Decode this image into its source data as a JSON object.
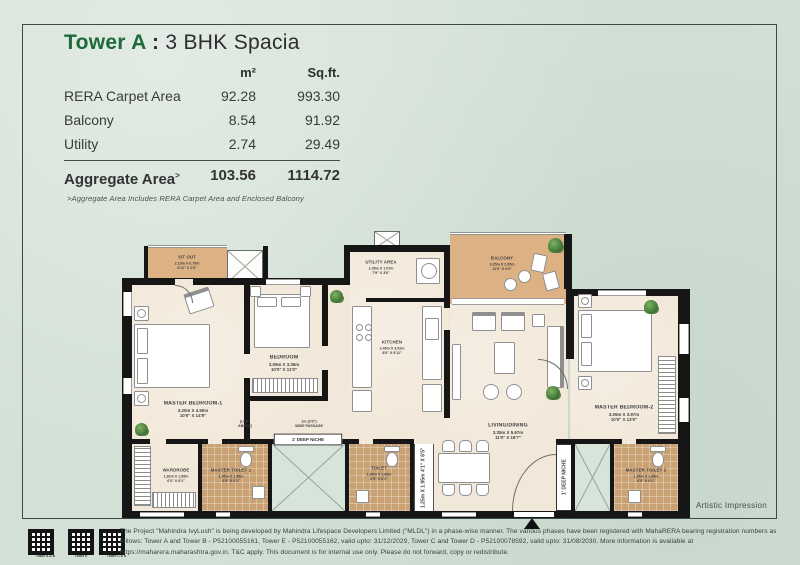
{
  "title": {
    "tower": "Tower A",
    "colon": " : ",
    "plan": "3 BHK Spacia"
  },
  "area_table": {
    "headers": {
      "m2": "m²",
      "sqft": "Sq.ft."
    },
    "rows": [
      {
        "label": "RERA Carpet Area",
        "m2": "92.28",
        "sqft": "993.30"
      },
      {
        "label": "Balcony",
        "m2": "8.54",
        "sqft": "91.92"
      },
      {
        "label": "Utility",
        "m2": "2.74",
        "sqft": "29.49"
      }
    ],
    "aggregate": {
      "label": "Aggregate Area",
      "marker": "˃",
      "m2": "103.56",
      "sqft": "1114.72"
    },
    "footnote": "˃Aggregate Area Includes RERA Carpet Area and Enclosed Balcony"
  },
  "rooms": {
    "sit_out": {
      "name": "SIT OUT",
      "dim_m": "2.10m X 0.75m",
      "dim_ft": "6'11\" X 2'6\""
    },
    "master_bedroom_1": {
      "name": "MASTER BEDROOM-1",
      "dim_m": "3.20m X 4.50m",
      "dim_ft": "10'6\" X 14'9\""
    },
    "bedroom": {
      "name": "BEDROOM",
      "dim_m": "3.05m X 3.35m",
      "dim_ft": "10'0\" X 11'0\""
    },
    "utility": {
      "name": "UTILITY AREA",
      "dim_m": "2.35m X 1.07m",
      "dim_ft": "7'9\" X 3'6\""
    },
    "kitchen": {
      "name": "KITCHEN",
      "dim_m": "2.45m X 3.02m",
      "dim_ft": "8'0\" X 9'11\""
    },
    "balcony": {
      "name": "BALCONY",
      "dim_m": "3.35m X 2.05m",
      "dim_ft": "11'0\" X 6'9\""
    },
    "living": {
      "name": "LIVING/DINING",
      "dim_m": "3.35m X 5.67m",
      "dim_ft": "11'0\" X 18'7\""
    },
    "master_bedroom_2": {
      "name": "MASTER BEDROOM-2",
      "dim_m": "3.05m X 3.97m",
      "dim_ft": "10'0\" X 13'0\""
    },
    "wardrobe": {
      "name": "WARDROBE",
      "dim_m": "1.82m X 1.85m",
      "dim_ft": "6'0\" X 6'1\""
    },
    "master_toilet_1": {
      "name": "MASTER TOILET 1",
      "dim_m": "1.95m X 1.85m",
      "dim_ft": "6'5\" X 6'1\""
    },
    "toilet": {
      "name": "TOILET",
      "dim_m": "1.95m X 1.85m",
      "dim_ft": "6'5\" X 6'1\""
    },
    "master_toilet_2": {
      "name": "MASTER TOILET 2",
      "dim_m": "1.95m X 1.85m",
      "dim_ft": "6'5\" X 6'1\""
    }
  },
  "plan_labels": {
    "loft_1": "(LOFT",
    "loft_2": "ABOVE)",
    "passage_1": "1m (3'3\")",
    "passage_2": "WIDE PASSAGE",
    "niche": "1' DEEP NICHE",
    "inner_passage_dim_m": "1.25m X 1.95m",
    "inner_passage_dim_ft": "4'1\" X 6'5\"",
    "artistic": "Artistic Impression"
  },
  "footer": {
    "qr_labels": [
      "Tower A & B",
      "Tower E",
      "Tower C & D"
    ],
    "disclaimer": "The Project \"Mahindra IvyLush\" is being developed by Mahindra Lifespace Developers Limited (\"MLDL\") in a phase-wise manner. The various phases have been registered with MahaRERA bearing registration numbers as follows: Tower A and Tower B - P52100055161, Tower E - P52100055162, valid upto: 31/12/2029, Tower C and Tower D - P52100078592, valid upto: 31/08/2030. More information is available at https://maharera.maharashtra.gov.in. T&C apply. This document is for internal use only. Please do not forward, copy or redistribute."
  }
}
